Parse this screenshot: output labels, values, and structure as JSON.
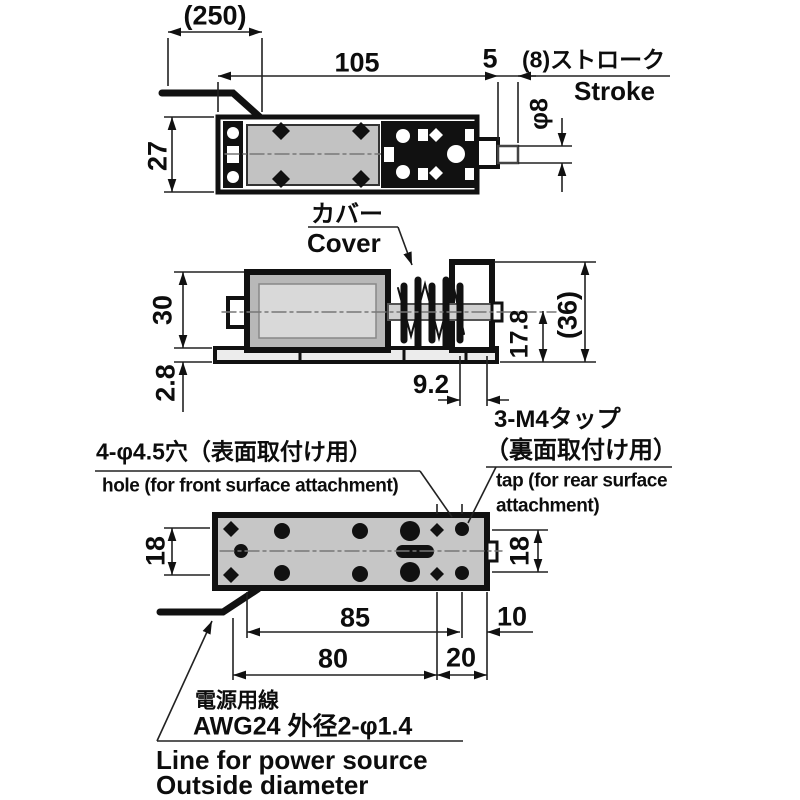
{
  "drawing_title": "solenoid outline dimensional drawing",
  "colors": {
    "line": "#111111",
    "panel_gray": "#c2c2c2",
    "background": "#ffffff"
  },
  "top_view": {
    "dims": {
      "cable_length": "(250)",
      "body_length": "105",
      "plunger_step": "5",
      "stroke_jp": "(8)ストローク",
      "stroke_en": "Stroke",
      "shaft_diameter": "φ8",
      "body_width": "27"
    }
  },
  "side_view": {
    "cover_label_jp": "カバー",
    "cover_label_en": "Cover",
    "dims": {
      "body_height": "30",
      "base_thickness": "2.8",
      "shaft_clearance": "9.2",
      "center_height": "17.8",
      "overall_height": "(36)"
    }
  },
  "bottom_view": {
    "hole_note_jp": "4-φ4.5穴（表面取付け用）",
    "hole_note_en": "hole (for front surface attachment)",
    "tap_note_jp1": "3-M4タップ",
    "tap_note_jp2": "（裏面取付け用）",
    "tap_note_en1": "tap (for rear surface",
    "tap_note_en2": "attachment)",
    "dims": {
      "row_spacing_left": "18",
      "row_spacing_right": "18",
      "hole_span": "85",
      "tap_offset": "10",
      "mount_span": "80",
      "tap_span": "20"
    }
  },
  "power_note": {
    "jp1": "電源用線",
    "jp2": "AWG24 外径2-φ1.4",
    "en1": "Line for power source",
    "en2": "Outside diameter"
  }
}
